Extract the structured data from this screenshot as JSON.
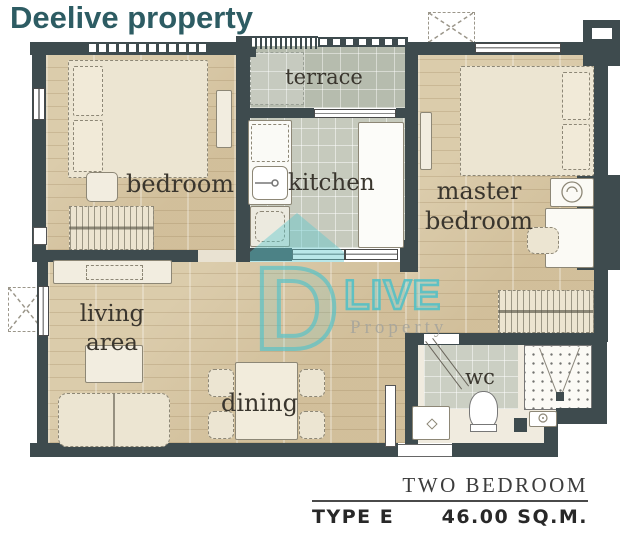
{
  "title": "Deelive property",
  "rooms": {
    "terrace": "terrace",
    "kitchen": "kitchen",
    "bedroom": "bedroom",
    "master_bedroom": "master bedroom",
    "living_area": "living area",
    "dining": "dining",
    "wc": "wc"
  },
  "watermark": {
    "logo": "D",
    "live": "LIVE",
    "property": "Property"
  },
  "legend": {
    "type_name": "TWO BEDROOM",
    "type_code": "TYPE E",
    "area": "46.00 SQ.M."
  },
  "colors": {
    "title": "#2d5c63",
    "wall": "#3e4b4e",
    "wood_floor": "#d7c6a2",
    "terrace_tile": "#b6bcae",
    "kitchen_tile": "#c6cabd",
    "accent_teal": "#5ec7cc",
    "label_text": "#3a362e"
  }
}
